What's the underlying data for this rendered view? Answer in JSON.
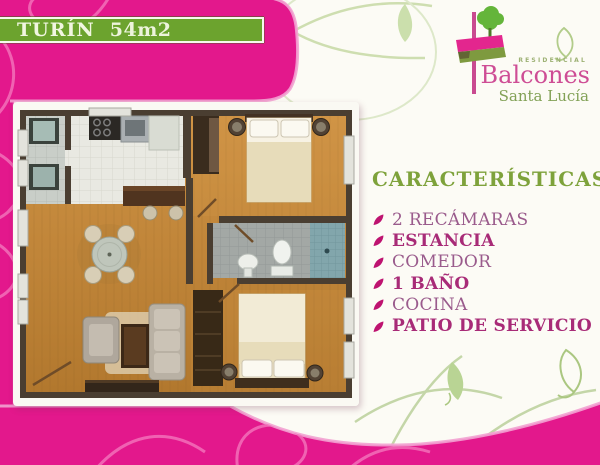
{
  "banner": {
    "title": "TURÍN",
    "area": "54m2"
  },
  "logo": {
    "residencial": "RESIDENCIAL",
    "name": "Balcones",
    "subtitle": "Santa Lucía"
  },
  "features": {
    "heading": "CARACTERÍSTICAS",
    "items": [
      {
        "label": "2 RECÁMARAS",
        "emphasis": false
      },
      {
        "label": "ESTANCIA",
        "emphasis": true
      },
      {
        "label": "COMEDOR",
        "emphasis": false
      },
      {
        "label": "1 BAÑO",
        "emphasis": true
      },
      {
        "label": "COCINA",
        "emphasis": false
      },
      {
        "label": "PATIO DE SERVICIO",
        "emphasis": true
      }
    ]
  },
  "floor_plan": {
    "alt": "Plano arquitectónico Turín 54m2 vista superior"
  },
  "colors": {
    "magenta": "#E3188C",
    "light_pink_edge": "#F2A2D1",
    "banner_green": "#6CA32E",
    "heading_green": "#7EA23B",
    "item_plum": "#9A5B8C",
    "item_magenta": "#A82B77",
    "bullet_magenta": "#BE1370",
    "logo_pink": "#CE4D95",
    "logo_green": "#82A156"
  }
}
